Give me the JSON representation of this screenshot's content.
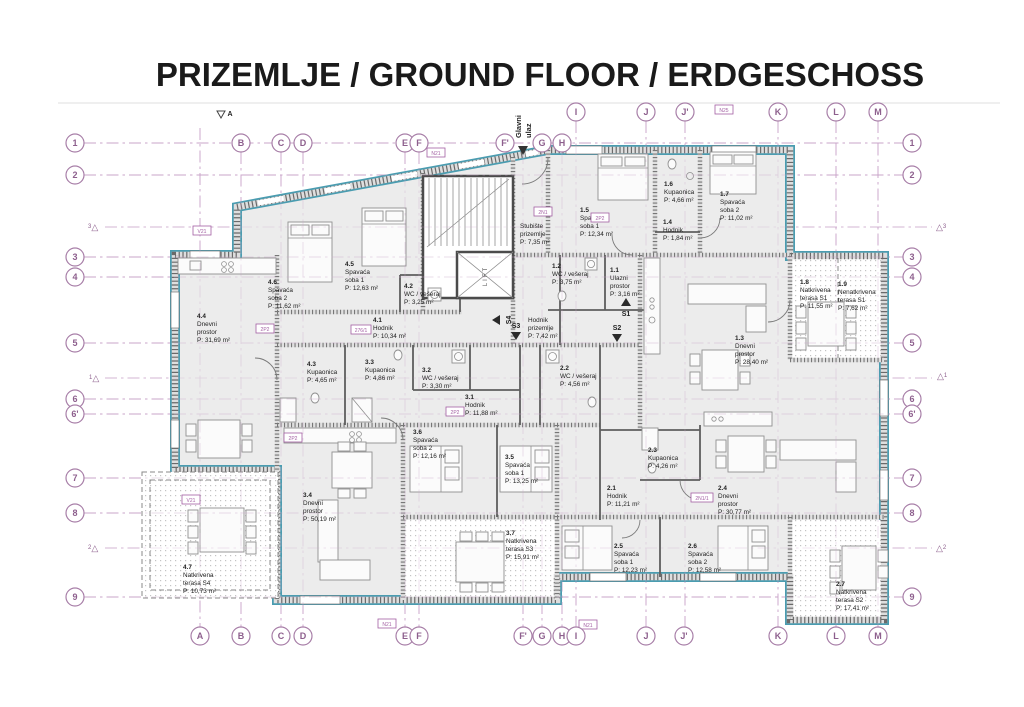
{
  "title": "PRIZEMLJE / GROUND FLOOR / ERDGESCHOSS",
  "entrance": {
    "line1": "Glavni",
    "line2": "ulaz"
  },
  "lift_label": "LIFT",
  "grid": {
    "top_letters": [
      "B",
      "C",
      "D",
      "E",
      "F",
      "F'",
      "G",
      "H",
      "I",
      "J",
      "J'",
      "K",
      "L",
      "M"
    ],
    "bottom_letters": [
      "A",
      "B",
      "C",
      "D",
      "E",
      "F",
      "F'",
      "G",
      "H",
      "I",
      "J",
      "J'",
      "K",
      "L",
      "M"
    ],
    "left_numbers": [
      "1",
      "2",
      "3",
      "4",
      "5",
      "6",
      "6'",
      "7",
      "8",
      "9"
    ],
    "right_numbers": [
      "1",
      "2",
      "3",
      "4",
      "5",
      "6",
      "6'",
      "7",
      "8",
      "9"
    ],
    "delta_marks": [
      "3",
      "1",
      "2"
    ],
    "delta_symbol": "△"
  },
  "section_markers": {
    "s1": "S1",
    "s2": "S2",
    "s3": "S3",
    "s4": "S4",
    "a": "A"
  },
  "rooms": [
    {
      "l1": "4.4",
      "l2": "Dnevni",
      "l3": "prostor",
      "l4": "P: 31,69 m²"
    },
    {
      "l1": "4.6",
      "l2": "Spavaća",
      "l3": "soba 2",
      "l4": "P: 11,62 m²"
    },
    {
      "l1": "4.5",
      "l2": "Spavaća",
      "l3": "soba 1",
      "l4": "P: 12,63 m²"
    },
    {
      "l1": "4.1",
      "l2": "Hodnik",
      "l3": "P: 10,34 m²",
      "l4": ""
    },
    {
      "l1": "4.2",
      "l2": "WC / vešeraj",
      "l3": "P: 3,25 m²",
      "l4": ""
    },
    {
      "l1": "4.3",
      "l2": "Kupaonica",
      "l3": "P: 4,65 m²",
      "l4": ""
    },
    {
      "l1": "3.3",
      "l2": "Kupaonica",
      "l3": "P: 4,86 m²",
      "l4": ""
    },
    {
      "l1": "3.2",
      "l2": "WC / vešeraj",
      "l3": "P: 3,30 m²",
      "l4": ""
    },
    {
      "l1": "3.1",
      "l2": "Hodnik",
      "l3": "P: 11,88 m²",
      "l4": ""
    },
    {
      "l1": "3.4",
      "l2": "Dnevni",
      "l3": "prostor",
      "l4": "P: 50,19 m²"
    },
    {
      "l1": "3.6",
      "l2": "Spavaća",
      "l3": "soba 2",
      "l4": "P: 12,16 m²"
    },
    {
      "l1": "3.5",
      "l2": "Spavaća",
      "l3": "soba 1",
      "l4": "P: 13,25 m²"
    },
    {
      "l1": "3.7",
      "l2": "Natkrivena",
      "l3": "terasa S3",
      "l4": "P: 15,91 m²"
    },
    {
      "l1": "4.7",
      "l2": "Natkrivena",
      "l3": "terasa S4",
      "l4": "P: 10,73 m²"
    },
    {
      "l1": "2.1",
      "l2": "Hodnik",
      "l3": "P: 11,21 m²",
      "l4": ""
    },
    {
      "l1": "2.2",
      "l2": "WC / vešeraj",
      "l3": "P: 4,56 m²",
      "l4": ""
    },
    {
      "l1": "2.3",
      "l2": "Kupaonica",
      "l3": "P: 4,26 m²",
      "l4": ""
    },
    {
      "l1": "2.4",
      "l2": "Dnevni",
      "l3": "prostor",
      "l4": "P: 30,77 m²"
    },
    {
      "l1": "2.5",
      "l2": "Spavaća",
      "l3": "soba 1",
      "l4": "P: 12,23 m²"
    },
    {
      "l1": "2.6",
      "l2": "Spavaća",
      "l3": "soba 2",
      "l4": "P: 12,58 m²"
    },
    {
      "l1": "2.7",
      "l2": "Natkrivena",
      "l3": "terasa S2",
      "l4": "P: 17,41 m²"
    },
    {
      "l1": "1.1",
      "l2": "Ulazni",
      "l3": "prostor",
      "l4": "P: 3,16 m²"
    },
    {
      "l1": "1.2",
      "l2": "WC / vešeraj",
      "l3": "P: 3,75 m²",
      "l4": ""
    },
    {
      "l1": "1.3",
      "l2": "Dnevni",
      "l3": "prostor",
      "l4": "P: 28,40 m²"
    },
    {
      "l1": "1.4",
      "l2": "Hodnik",
      "l3": "P: 1,84 m²",
      "l4": ""
    },
    {
      "l1": "1.5",
      "l2": "Spavaća",
      "l3": "soba 1",
      "l4": "P: 12,34 m²"
    },
    {
      "l1": "1.6",
      "l2": "Kupaonica",
      "l3": "P: 4,66 m²",
      "l4": ""
    },
    {
      "l1": "1.7",
      "l2": "Spavaća",
      "l3": "soba 2",
      "l4": "P: 11,02 m²"
    },
    {
      "l1": "1.8",
      "l2": "Natkrivena",
      "l3": "terasa S1",
      "l4": "P: 11,55 m²"
    },
    {
      "l1": "1.9",
      "l2": "Nenatkrivena",
      "l3": "terasa S1",
      "l4": "P: 7,62 m²"
    },
    {
      "l1": "",
      "l2": "Stubište",
      "l3": "prizemlje",
      "l4": "P: 7,35 m²"
    },
    {
      "l1": "",
      "l2": "Hodnik",
      "l3": "prizemlje",
      "l4": "P: 7,42 m²"
    }
  ],
  "tags": [
    "V21",
    "N21",
    "N25",
    "2N1",
    "2P2",
    "2P2",
    "276/1",
    "2P2",
    "2P2",
    "2N1/1",
    "V21",
    "N21",
    "N21"
  ],
  "colors": {
    "teal_exterior": "#4a9cb0",
    "grid_purple": "#b286b2",
    "tag_purple": "#a35fa3",
    "wall_gray": "#6a6a6a",
    "room_fill": "#ececec",
    "text": "#1f1f1f"
  }
}
